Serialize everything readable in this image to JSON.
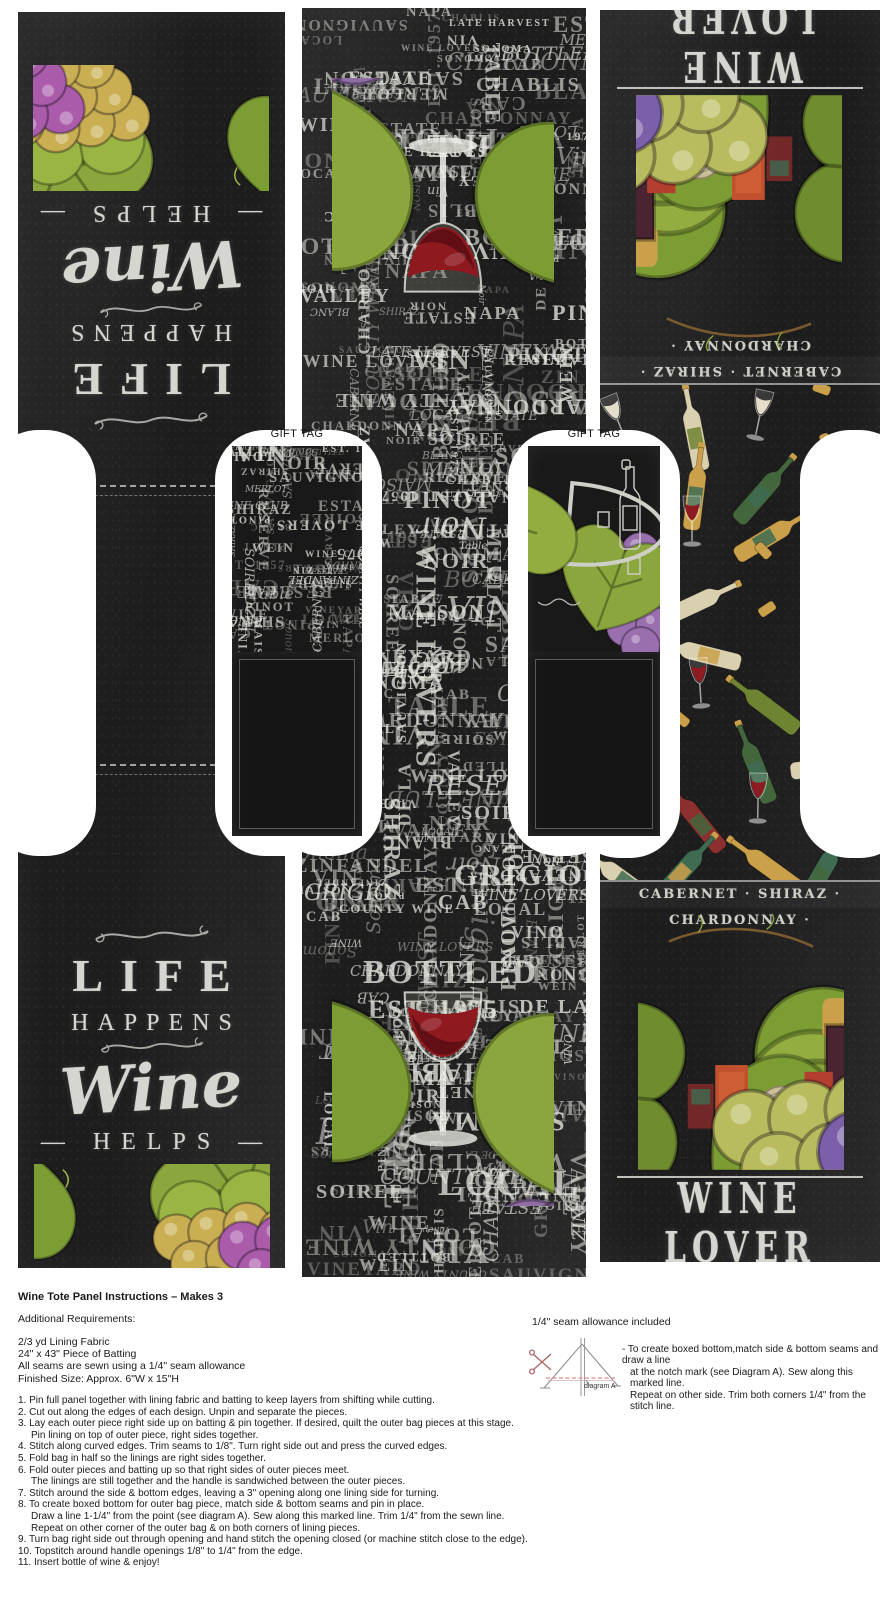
{
  "left_panel": {
    "quote": {
      "life": "LIFE",
      "happens": "HAPPENS",
      "wine": "Wine",
      "helps": "— HELPS —"
    }
  },
  "right_panel": {
    "headline": "WINE LOVER",
    "band": "CABERNET · SHIRAZ · CHARDONNAY ·"
  },
  "gift_tag": {
    "label": "GIFT TAG"
  },
  "fabric": {
    "words": [
      "CHARDONNAY",
      "BLANC",
      "Pinot",
      "Noir",
      "CABERNET",
      "SAUVIGNON",
      "ZINFANDEL",
      "MERLOT",
      "ZIN",
      "CAB",
      "VIN",
      "VINO",
      "VINEYARD",
      "ESTATE",
      "BOTTLED",
      "RESERVE",
      "WINE",
      "WEIN",
      "WINE CLUB",
      "SHIRAZ",
      "SOIREE",
      "CHABLIS",
      "GRIGIO",
      "PINOT",
      "NAPA",
      "Valley",
      "Sonoma",
      "Sauvignon",
      "LATE HARVEST",
      "WINE LOVERS",
      "COUNTY WINE",
      "MAISON",
      "DE LA",
      "EST. 1975",
      "Est. 1957",
      "Table",
      "Vin",
      "LOCAL"
    ],
    "bottle_colors": [
      "#6f8432",
      "#d8d0ae",
      "#44663c",
      "#8c2f2f",
      "#caa04a",
      "#3f6b52"
    ],
    "wine_colors": [
      "#8e1a22",
      "#e4decb"
    ]
  },
  "colors": {
    "panel_black": "#1d1d1d",
    "chalk": "#d6d6d0",
    "wine_red": "#8e1a20",
    "grape_purple": "#8f6da5",
    "grape_magenta": "#aa5cab",
    "grape_blue": "#6c60a8",
    "grape_green": "#b9bc5e",
    "leaf_green": "#8aa63c",
    "cork_gold": "#caa04a",
    "diagram_red": "#e08a8a"
  },
  "instructions": {
    "title": "Wine Tote Panel Instructions – Makes 3",
    "additional_title": "Additional Requirements:",
    "requirements": [
      "2/3 yd Lining Fabric",
      "24\" x 43\" Piece of Batting",
      "All seams are sewn using a 1/4\" seam allowance",
      "Finished Size: Approx. 6\"W x 15\"H"
    ],
    "seam_note": "1/4\" seam allowance included",
    "diagram_label": "diagram A",
    "boxed_note": [
      "- To create boxed bottom,match side & bottom seams and draw a line",
      "at the notch mark (see Diagram A). Sew along this marked line.",
      "Repeat on other side. Trim both corners 1/4\" from the stitch line."
    ],
    "steps": [
      {
        "num": "1.",
        "lines": [
          "Pin full panel together with lining fabric and batting to keep layers from shifting while cutting."
        ]
      },
      {
        "num": "2.",
        "lines": [
          "Cut out along the edges of each design. Unpin and separate the pieces."
        ]
      },
      {
        "num": "3.",
        "lines": [
          "Lay each outer piece right side up on batting & pin together. If desired, quilt the outer bag pieces at this stage.",
          "Pin lining on top of outer piece, right sides together."
        ]
      },
      {
        "num": "4.",
        "lines": [
          "Stitch along curved edges. Trim seams to 1/8\". Turn right side out and press the curved edges."
        ]
      },
      {
        "num": "5.",
        "lines": [
          "Fold bag in half so the linings are right sides together."
        ]
      },
      {
        "num": "6.",
        "lines": [
          "Fold outer pieces and batting up so that right sides of outer pieces meet.",
          "The linings are still together and the handle is sandwiched between the outer pieces."
        ]
      },
      {
        "num": "7.",
        "lines": [
          "Stitch around the side & bottom edges, leaving a 3\" opening along one lining side for turning."
        ]
      },
      {
        "num": "8.",
        "lines": [
          "To create boxed bottom for outer bag piece, match side & bottom seams and pin in place.",
          "Draw a line 1-1/4\" from the point (see diagram A). Sew along this marked line. Trim 1/4\" from the sewn line.",
          "Repeat on other corner of the outer bag & on both corners of lining pieces."
        ]
      },
      {
        "num": "9.",
        "lines": [
          "Turn bag right side out through opening and hand stitch the opening closed (or machine stitch close to the edge)."
        ]
      },
      {
        "num": "10.",
        "lines": [
          "Topstitch around handle openings 1/8\" to 1/4\" from the edge."
        ]
      },
      {
        "num": "11.",
        "lines": [
          "Insert bottle of wine & enjoy!"
        ]
      }
    ]
  }
}
